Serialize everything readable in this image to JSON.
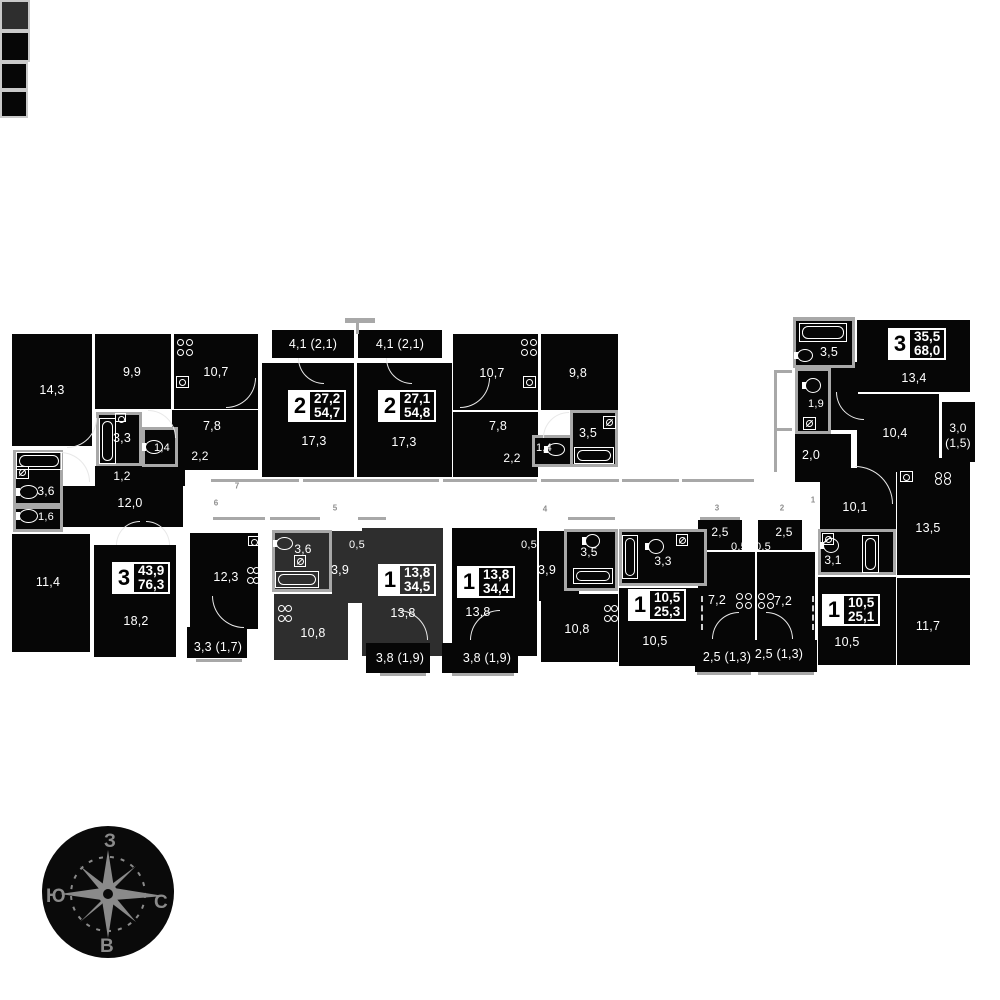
{
  "colors": {
    "block": "#060606",
    "highlight": "#2e2e2e",
    "wall": "#a8a8a8",
    "marker": "#8d8d8d",
    "star": "#8a8a8a",
    "paper": "#ffffff"
  },
  "compass": {
    "top": "З",
    "left": "Ю",
    "right": "С",
    "bottom": "В"
  },
  "badges": [
    {
      "x": 112,
      "y": 562,
      "n": "3",
      "a1": "43,9",
      "a2": "76,3",
      "bg": "#060606"
    },
    {
      "x": 288,
      "y": 390,
      "n": "2",
      "a1": "27,2",
      "a2": "54,7",
      "bg": "#060606"
    },
    {
      "x": 378,
      "y": 390,
      "n": "2",
      "a1": "27,1",
      "a2": "54,8",
      "bg": "#060606"
    },
    {
      "x": 888,
      "y": 328,
      "n": "3",
      "a1": "35,5",
      "a2": "68,0",
      "bg": "#060606"
    },
    {
      "x": 378,
      "y": 564,
      "n": "1",
      "a1": "13,8",
      "a2": "34,5",
      "bg": "#2e2e2e"
    },
    {
      "x": 457,
      "y": 566,
      "n": "1",
      "a1": "13,8",
      "a2": "34,4",
      "bg": "#060606"
    },
    {
      "x": 628,
      "y": 589,
      "n": "1",
      "a1": "10,5",
      "a2": "25,3",
      "bg": "#060606"
    },
    {
      "x": 822,
      "y": 594,
      "n": "1",
      "a1": "10,5",
      "a2": "25,1",
      "bg": "#060606"
    }
  ],
  "labels": [
    {
      "x": 52,
      "y": 390,
      "t": "14,3"
    },
    {
      "x": 132,
      "y": 372,
      "t": "9,9"
    },
    {
      "x": 216,
      "y": 372,
      "t": "10,7"
    },
    {
      "x": 122,
      "y": 438,
      "t": "3,3"
    },
    {
      "x": 162,
      "y": 448,
      "t": "1,4",
      "s": 11
    },
    {
      "x": 212,
      "y": 426,
      "t": "7,8"
    },
    {
      "x": 200,
      "y": 456,
      "t": "2,2",
      "s": 12
    },
    {
      "x": 122,
      "y": 476,
      "t": "1,2",
      "s": 12
    },
    {
      "x": 130,
      "y": 503,
      "t": "12,0"
    },
    {
      "x": 46,
      "y": 491,
      "t": "3,6",
      "s": 12
    },
    {
      "x": 46,
      "y": 517,
      "t": "1,6",
      "s": 11
    },
    {
      "x": 48,
      "y": 582,
      "t": "11,4"
    },
    {
      "x": 136,
      "y": 621,
      "t": "18,2"
    },
    {
      "x": 226,
      "y": 577,
      "t": "12,3"
    },
    {
      "x": 218,
      "y": 647,
      "t": "3,3 (1,7)"
    },
    {
      "x": 313,
      "y": 344,
      "t": "4,1 (2,1)"
    },
    {
      "x": 400,
      "y": 344,
      "t": "4,1 (2,1)"
    },
    {
      "x": 314,
      "y": 441,
      "t": "17,3"
    },
    {
      "x": 404,
      "y": 442,
      "t": "17,3"
    },
    {
      "x": 492,
      "y": 373,
      "t": "10,7"
    },
    {
      "x": 578,
      "y": 373,
      "t": "9,8"
    },
    {
      "x": 498,
      "y": 426,
      "t": "7,8"
    },
    {
      "x": 512,
      "y": 458,
      "t": "2,2",
      "s": 12
    },
    {
      "x": 544,
      "y": 448,
      "t": "1,4",
      "s": 11
    },
    {
      "x": 588,
      "y": 433,
      "t": "3,5"
    },
    {
      "x": 829,
      "y": 352,
      "t": "3,5"
    },
    {
      "x": 914,
      "y": 378,
      "t": "13,4"
    },
    {
      "x": 816,
      "y": 404,
      "t": "1,9",
      "s": 11
    },
    {
      "x": 895,
      "y": 433,
      "t": "10,4"
    },
    {
      "x": 958,
      "y": 428,
      "t": "3,0",
      "s": 12
    },
    {
      "x": 958,
      "y": 443,
      "t": "(1,5)",
      "s": 12
    },
    {
      "x": 811,
      "y": 455,
      "t": "2,0"
    },
    {
      "x": 855,
      "y": 507,
      "t": "10,1"
    },
    {
      "x": 928,
      "y": 528,
      "t": "13,5"
    },
    {
      "x": 833,
      "y": 560,
      "t": "3,1",
      "s": 12
    },
    {
      "x": 847,
      "y": 642,
      "t": "10,5"
    },
    {
      "x": 928,
      "y": 626,
      "t": "11,7"
    },
    {
      "x": 303,
      "y": 549,
      "t": "3,6",
      "s": 12
    },
    {
      "x": 357,
      "y": 545,
      "t": "0,5",
      "s": 11
    },
    {
      "x": 340,
      "y": 570,
      "t": "3,9"
    },
    {
      "x": 403,
      "y": 613,
      "t": "13,8"
    },
    {
      "x": 313,
      "y": 633,
      "t": "10,8"
    },
    {
      "x": 400,
      "y": 658,
      "t": "3,8 (1,9)"
    },
    {
      "x": 529,
      "y": 545,
      "t": "0,5",
      "s": 11
    },
    {
      "x": 547,
      "y": 570,
      "t": "3,9"
    },
    {
      "x": 589,
      "y": 552,
      "t": "3,5",
      "s": 12
    },
    {
      "x": 478,
      "y": 612,
      "t": "13,8"
    },
    {
      "x": 577,
      "y": 629,
      "t": "10,8"
    },
    {
      "x": 487,
      "y": 658,
      "t": "3,8 (1,9)"
    },
    {
      "x": 663,
      "y": 561,
      "t": "3,3",
      "s": 12
    },
    {
      "x": 720,
      "y": 532,
      "t": "2,5",
      "s": 12
    },
    {
      "x": 739,
      "y": 547,
      "t": "0,5",
      "s": 11
    },
    {
      "x": 717,
      "y": 600,
      "t": "7,2"
    },
    {
      "x": 655,
      "y": 641,
      "t": "10,5"
    },
    {
      "x": 727,
      "y": 657,
      "t": "2,5 (1,3)"
    },
    {
      "x": 784,
      "y": 532,
      "t": "2,5",
      "s": 12
    },
    {
      "x": 763,
      "y": 547,
      "t": "0,5",
      "s": 11
    },
    {
      "x": 783,
      "y": 601,
      "t": "7,2"
    },
    {
      "x": 779,
      "y": 654,
      "t": "2,5 (1,3)"
    }
  ],
  "markers": [
    {
      "x": 237,
      "y": 486,
      "t": "7"
    },
    {
      "x": 216,
      "y": 503,
      "t": "6"
    },
    {
      "x": 335,
      "y": 508,
      "t": "5"
    },
    {
      "x": 545,
      "y": 509,
      "t": "4"
    },
    {
      "x": 717,
      "y": 508,
      "t": "3"
    },
    {
      "x": 782,
      "y": 508,
      "t": "2"
    },
    {
      "x": 813,
      "y": 500,
      "t": "1"
    }
  ],
  "blocks": [
    {
      "x": 12,
      "y": 334,
      "w": 80,
      "h": 112
    },
    {
      "x": 95,
      "y": 334,
      "w": 76,
      "h": 75
    },
    {
      "x": 174,
      "y": 334,
      "w": 84,
      "h": 75
    },
    {
      "x": 172,
      "y": 410,
      "w": 86,
      "h": 60
    },
    {
      "x": 95,
      "y": 466,
      "w": 90,
      "h": 20
    },
    {
      "x": 62,
      "y": 486,
      "w": 121,
      "h": 41
    },
    {
      "x": 12,
      "y": 534,
      "w": 78,
      "h": 118
    },
    {
      "x": 94,
      "y": 545,
      "w": 82,
      "h": 112
    },
    {
      "x": 190,
      "y": 533,
      "w": 68,
      "h": 96
    },
    {
      "x": 187,
      "y": 627,
      "w": 60,
      "h": 31
    },
    {
      "x": 272,
      "y": 330,
      "w": 82,
      "h": 28
    },
    {
      "x": 358,
      "y": 330,
      "w": 84,
      "h": 28
    },
    {
      "x": 262,
      "y": 363,
      "w": 92,
      "h": 114
    },
    {
      "x": 357,
      "y": 363,
      "w": 95,
      "h": 114
    },
    {
      "x": 453,
      "y": 334,
      "w": 85,
      "h": 76
    },
    {
      "x": 541,
      "y": 334,
      "w": 77,
      "h": 76
    },
    {
      "x": 453,
      "y": 412,
      "w": 85,
      "h": 65
    },
    {
      "x": 857,
      "y": 320,
      "w": 113,
      "h": 72
    },
    {
      "x": 828,
      "y": 362,
      "w": 30,
      "h": 68
    },
    {
      "x": 857,
      "y": 394,
      "w": 82,
      "h": 78
    },
    {
      "x": 942,
      "y": 402,
      "w": 33,
      "h": 60
    },
    {
      "x": 795,
      "y": 434,
      "w": 56,
      "h": 48
    },
    {
      "x": 820,
      "y": 468,
      "w": 76,
      "h": 62
    },
    {
      "x": 897,
      "y": 458,
      "w": 73,
      "h": 117
    },
    {
      "x": 818,
      "y": 577,
      "w": 78,
      "h": 88
    },
    {
      "x": 897,
      "y": 578,
      "w": 73,
      "h": 87
    },
    {
      "x": 332,
      "y": 531,
      "w": 44,
      "h": 72,
      "c": "#2e2e2e"
    },
    {
      "x": 274,
      "y": 594,
      "w": 74,
      "h": 66,
      "c": "#2e2e2e"
    },
    {
      "x": 362,
      "y": 528,
      "w": 81,
      "h": 128,
      "c": "#2e2e2e"
    },
    {
      "x": 366,
      "y": 643,
      "w": 64,
      "h": 30
    },
    {
      "x": 452,
      "y": 528,
      "w": 85,
      "h": 128
    },
    {
      "x": 539,
      "y": 531,
      "w": 40,
      "h": 70
    },
    {
      "x": 541,
      "y": 594,
      "w": 77,
      "h": 68
    },
    {
      "x": 442,
      "y": 643,
      "w": 76,
      "h": 30
    },
    {
      "x": 619,
      "y": 588,
      "w": 86,
      "h": 78
    },
    {
      "x": 698,
      "y": 520,
      "w": 44,
      "h": 30
    },
    {
      "x": 698,
      "y": 552,
      "w": 57,
      "h": 88
    },
    {
      "x": 695,
      "y": 640,
      "w": 60,
      "h": 32
    },
    {
      "x": 758,
      "y": 520,
      "w": 44,
      "h": 30
    },
    {
      "x": 757,
      "y": 552,
      "w": 58,
      "h": 88
    },
    {
      "x": 755,
      "y": 640,
      "w": 62,
      "h": 32
    }
  ],
  "boxes": [
    {
      "x": 96,
      "y": 412,
      "w": 46,
      "h": 54
    },
    {
      "x": 142,
      "y": 427,
      "w": 36,
      "h": 40
    },
    {
      "x": 13,
      "y": 450,
      "w": 50,
      "h": 56
    },
    {
      "x": 13,
      "y": 506,
      "w": 50,
      "h": 26
    },
    {
      "x": 532,
      "y": 435,
      "w": 42,
      "h": 32
    },
    {
      "x": 570,
      "y": 410,
      "w": 48,
      "h": 57
    },
    {
      "x": 793,
      "y": 318,
      "w": 62,
      "h": 50
    },
    {
      "x": 795,
      "y": 368,
      "w": 36,
      "h": 66
    },
    {
      "x": 818,
      "y": 529,
      "w": 78,
      "h": 46
    },
    {
      "x": 272,
      "y": 530,
      "w": 60,
      "h": 62,
      "c": "#2e2e2e"
    },
    {
      "x": 564,
      "y": 529,
      "w": 54,
      "h": 62
    },
    {
      "x": 619,
      "y": 529,
      "w": 88,
      "h": 57
    }
  ],
  "cboxes": [
    {
      "x": 344,
      "y": 531,
      "w": 26,
      "h": 27,
      "c": "#2e2e2e"
    },
    {
      "x": 516,
      "y": 531,
      "w": 26,
      "h": 27
    },
    {
      "x": 727,
      "y": 536,
      "w": 24,
      "h": 24
    },
    {
      "x": 751,
      "y": 536,
      "w": 24,
      "h": 24
    }
  ],
  "walls": [
    {
      "x": 345,
      "y": 318,
      "w": 30,
      "h": 5
    },
    {
      "x": 356,
      "y": 322,
      "w": 3,
      "h": 12
    },
    {
      "x": 211,
      "y": 479,
      "w": 88,
      "h": 3
    },
    {
      "x": 303,
      "y": 479,
      "w": 136,
      "h": 3
    },
    {
      "x": 443,
      "y": 479,
      "w": 94,
      "h": 3
    },
    {
      "x": 541,
      "y": 479,
      "w": 78,
      "h": 3
    },
    {
      "x": 622,
      "y": 479,
      "w": 57,
      "h": 3
    },
    {
      "x": 682,
      "y": 479,
      "w": 72,
      "h": 3
    },
    {
      "x": 213,
      "y": 517,
      "w": 52,
      "h": 3
    },
    {
      "x": 270,
      "y": 517,
      "w": 50,
      "h": 3
    },
    {
      "x": 358,
      "y": 517,
      "w": 28,
      "h": 3
    },
    {
      "x": 568,
      "y": 517,
      "w": 47,
      "h": 3
    },
    {
      "x": 700,
      "y": 517,
      "w": 40,
      "h": 3
    },
    {
      "x": 774,
      "y": 370,
      "w": 3,
      "h": 102
    },
    {
      "x": 774,
      "y": 370,
      "w": 18,
      "h": 3
    },
    {
      "x": 774,
      "y": 428,
      "w": 18,
      "h": 3
    },
    {
      "x": 196,
      "y": 659,
      "w": 46,
      "h": 3
    },
    {
      "x": 380,
      "y": 673,
      "w": 46,
      "h": 3
    },
    {
      "x": 452,
      "y": 673,
      "w": 62,
      "h": 3
    },
    {
      "x": 697,
      "y": 672,
      "w": 54,
      "h": 3
    },
    {
      "x": 758,
      "y": 672,
      "w": 56,
      "h": 3
    },
    {
      "x": 793,
      "y": 317,
      "w": 62,
      "h": 4
    }
  ],
  "arcs": [
    {
      "x": 67,
      "y": 418,
      "r": 30,
      "q": "br"
    },
    {
      "x": 148,
      "y": 410,
      "r": 28,
      "q": "tr"
    },
    {
      "x": 226,
      "y": 378,
      "r": 30,
      "q": "br"
    },
    {
      "x": 298,
      "y": 358,
      "r": 26,
      "q": "bl"
    },
    {
      "x": 386,
      "y": 358,
      "r": 26,
      "q": "bl"
    },
    {
      "x": 460,
      "y": 378,
      "r": 30,
      "q": "br"
    },
    {
      "x": 543,
      "y": 412,
      "r": 26,
      "q": "tl"
    },
    {
      "x": 116,
      "y": 521,
      "r": 24,
      "q": "tl"
    },
    {
      "x": 146,
      "y": 521,
      "r": 24,
      "q": "tr"
    },
    {
      "x": 212,
      "y": 596,
      "r": 32,
      "q": "bl"
    },
    {
      "x": 398,
      "y": 610,
      "r": 30,
      "q": "tr"
    },
    {
      "x": 470,
      "y": 610,
      "r": 30,
      "q": "tl"
    },
    {
      "x": 712,
      "y": 612,
      "r": 27,
      "q": "tl"
    },
    {
      "x": 766,
      "y": 612,
      "r": 27,
      "q": "tr"
    },
    {
      "x": 855,
      "y": 466,
      "r": 38,
      "q": "tr"
    },
    {
      "x": 836,
      "y": 392,
      "r": 28,
      "q": "bl"
    },
    {
      "x": 60,
      "y": 452,
      "r": 30,
      "q": "tr"
    }
  ],
  "dashes": [
    {
      "x": 812,
      "y": 596,
      "h": 34
    },
    {
      "x": 701,
      "y": 596,
      "h": 34
    }
  ],
  "fixtures": [
    {
      "t": "tub",
      "x": 99,
      "y": 418,
      "w": 17,
      "h": 46
    },
    {
      "t": "tub",
      "x": 16,
      "y": 452,
      "w": 46,
      "h": 18
    },
    {
      "t": "tub",
      "x": 574,
      "y": 447,
      "w": 40,
      "h": 17
    },
    {
      "t": "tub",
      "x": 799,
      "y": 323,
      "w": 48,
      "h": 19
    },
    {
      "t": "tub",
      "x": 275,
      "y": 571,
      "w": 44,
      "h": 17
    },
    {
      "t": "tub",
      "x": 573,
      "y": 568,
      "w": 40,
      "h": 16
    },
    {
      "t": "tub",
      "x": 622,
      "y": 535,
      "w": 16,
      "h": 44
    },
    {
      "t": "tub",
      "x": 862,
      "y": 535,
      "w": 17,
      "h": 38
    },
    {
      "t": "wc",
      "x": 145,
      "y": 440,
      "w": 18,
      "h": 14
    },
    {
      "t": "wc",
      "x": 19,
      "y": 485,
      "w": 19,
      "h": 14
    },
    {
      "t": "wc",
      "x": 19,
      "y": 509,
      "w": 19,
      "h": 14
    },
    {
      "t": "wc",
      "x": 547,
      "y": 443,
      "w": 18,
      "h": 13
    },
    {
      "t": "wc",
      "x": 585,
      "y": 534,
      "w": 15,
      "h": 14
    },
    {
      "t": "wc",
      "x": 648,
      "y": 539,
      "w": 16,
      "h": 15
    },
    {
      "t": "wc",
      "x": 823,
      "y": 538,
      "w": 16,
      "h": 15
    },
    {
      "t": "wc",
      "x": 797,
      "y": 349,
      "w": 16,
      "h": 13
    },
    {
      "t": "wc",
      "x": 805,
      "y": 378,
      "w": 16,
      "h": 15
    },
    {
      "t": "wc",
      "x": 276,
      "y": 537,
      "w": 17,
      "h": 13
    },
    {
      "t": "stove",
      "x": 176,
      "y": 338,
      "w": 17,
      "h": 18
    },
    {
      "t": "stove",
      "x": 246,
      "y": 566,
      "w": 14,
      "h": 18
    },
    {
      "t": "stove",
      "x": 520,
      "y": 338,
      "w": 17,
      "h": 18
    },
    {
      "t": "stove",
      "x": 277,
      "y": 604,
      "w": 15,
      "h": 18
    },
    {
      "t": "stove",
      "x": 603,
      "y": 604,
      "w": 15,
      "h": 18
    },
    {
      "t": "stove",
      "x": 735,
      "y": 592,
      "w": 17,
      "h": 17
    },
    {
      "t": "stove",
      "x": 757,
      "y": 592,
      "w": 17,
      "h": 17
    },
    {
      "t": "stove",
      "x": 934,
      "y": 471,
      "w": 17,
      "h": 14
    },
    {
      "t": "sink",
      "x": 176,
      "y": 376,
      "w": 13,
      "h": 12
    },
    {
      "t": "sink",
      "x": 523,
      "y": 376,
      "w": 13,
      "h": 12
    },
    {
      "t": "sink",
      "x": 900,
      "y": 471,
      "w": 13,
      "h": 11
    },
    {
      "t": "sink",
      "x": 248,
      "y": 536,
      "w": 11,
      "h": 10
    },
    {
      "t": "sink",
      "x": 115,
      "y": 413,
      "w": 11,
      "h": 9
    },
    {
      "t": "wash",
      "x": 16,
      "y": 466,
      "w": 13,
      "h": 13
    },
    {
      "t": "wash",
      "x": 603,
      "y": 416,
      "w": 13,
      "h": 13
    },
    {
      "t": "wash",
      "x": 803,
      "y": 417,
      "w": 13,
      "h": 13
    },
    {
      "t": "wash",
      "x": 822,
      "y": 533,
      "w": 12,
      "h": 12
    },
    {
      "t": "wash",
      "x": 676,
      "y": 534,
      "w": 12,
      "h": 12
    },
    {
      "t": "wash",
      "x": 294,
      "y": 555,
      "w": 12,
      "h": 12
    }
  ]
}
